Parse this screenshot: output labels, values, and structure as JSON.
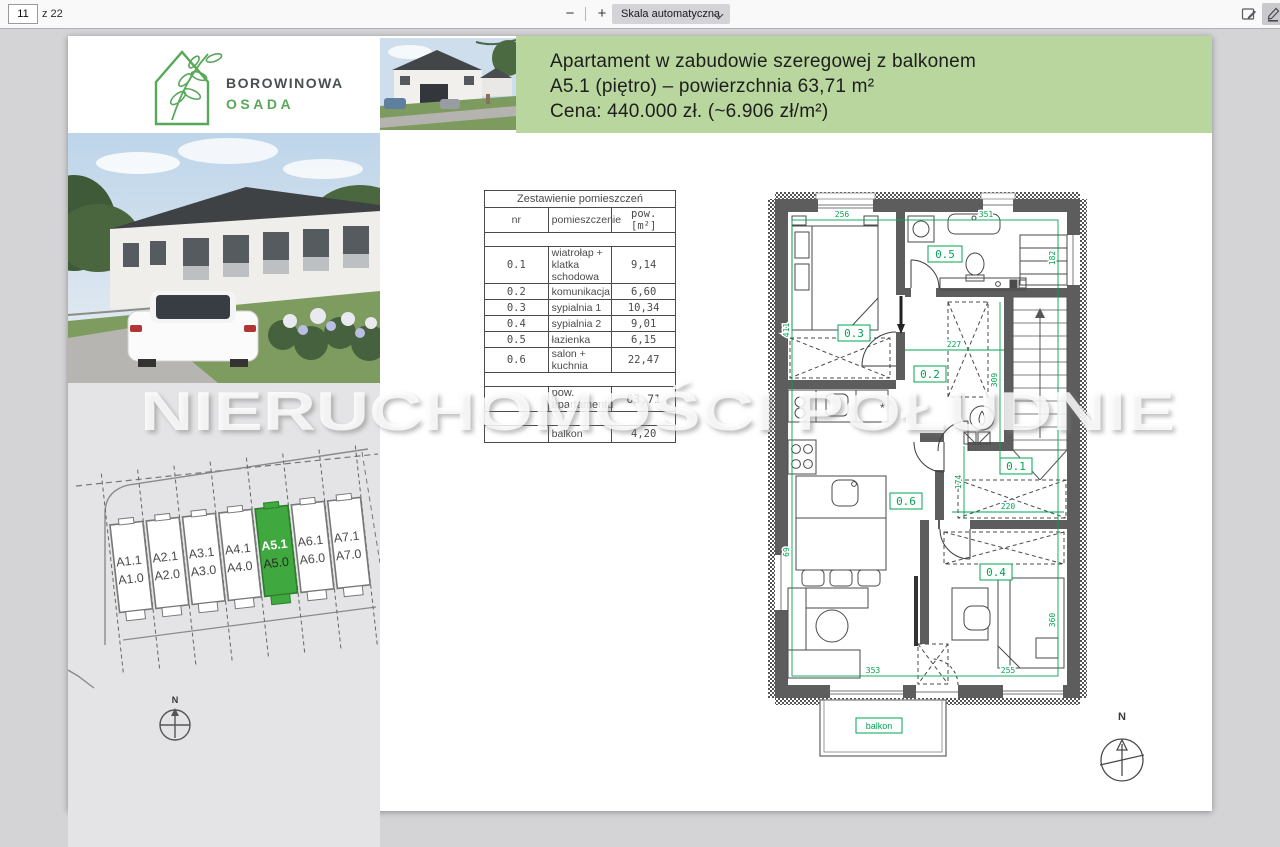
{
  "toolbar": {
    "page_input": "11",
    "page_count": "z 22",
    "zoom_out": "−",
    "zoom_in": "+",
    "scale_select": "Skala automatyczna"
  },
  "logo": {
    "line1": "BOROWINOWA",
    "line2": "OSADA"
  },
  "header": {
    "bg_color": "#b8d69d",
    "line1": "Apartament w zabudowie szeregowej z balkonem",
    "line2": "A5.1 (piętro) – powierzchnia 63,71 m²",
    "line3": "Cena: 440.000 zł. (~6.906 zł/m²)"
  },
  "table": {
    "title": "Zestawienie pomieszczeń",
    "col_nr": "nr",
    "col_name": "pomieszczenie",
    "col_area": "pow. [m²]",
    "rows": [
      {
        "nr": "0.1",
        "name": "wiatrołap + klatka schodowa",
        "area": "9,14"
      },
      {
        "nr": "0.2",
        "name": "komunikacja",
        "area": "6,60"
      },
      {
        "nr": "0.3",
        "name": "sypialnia 1",
        "area": "10,34"
      },
      {
        "nr": "0.4",
        "name": "sypialnia 2",
        "area": "9,01"
      },
      {
        "nr": "0.5",
        "name": "łazienka",
        "area": "6,15"
      },
      {
        "nr": "0.6",
        "name": "salon + kuchnia",
        "area": "22,47"
      }
    ],
    "total_label": "pow. apartamentu",
    "total_value": "63,71",
    "balcony_label": "balkon",
    "balcony_value": "4,20"
  },
  "site_plan": {
    "north": "N",
    "highlighted_unit": "A5.1",
    "highlight_color": "#3fa83f",
    "units": [
      {
        "upper": "A1.1",
        "lower": "A1.0"
      },
      {
        "upper": "A2.1",
        "lower": "A2.0"
      },
      {
        "upper": "A3.1",
        "lower": "A3.0"
      },
      {
        "upper": "A4.1",
        "lower": "A4.0"
      },
      {
        "upper": "A5.1",
        "lower": "A5.0"
      },
      {
        "upper": "A6.1",
        "lower": "A6.0"
      },
      {
        "upper": "A7.1",
        "lower": "A7.0"
      }
    ]
  },
  "floor_plan": {
    "north": "N",
    "balcony_label": "balkon",
    "accent_color": "#00a651",
    "room_labels": {
      "r1": "0.1",
      "r2": "0.2",
      "r3": "0.3",
      "r4": "0.4",
      "r5": "0.5",
      "r6": "0.6"
    },
    "dims": {
      "top_left": "256",
      "top_right": "351",
      "left_top": "411",
      "right_top": "182",
      "corridor": "227",
      "corridor_v": "309",
      "hall_v": "174",
      "hall_w": "220",
      "left_bottom": "69",
      "bottom_left": "353",
      "bottom_right": "255",
      "right_bottom": "360"
    }
  },
  "watermark": "NIERUCHOMOŚCI POŁUDNIE"
}
